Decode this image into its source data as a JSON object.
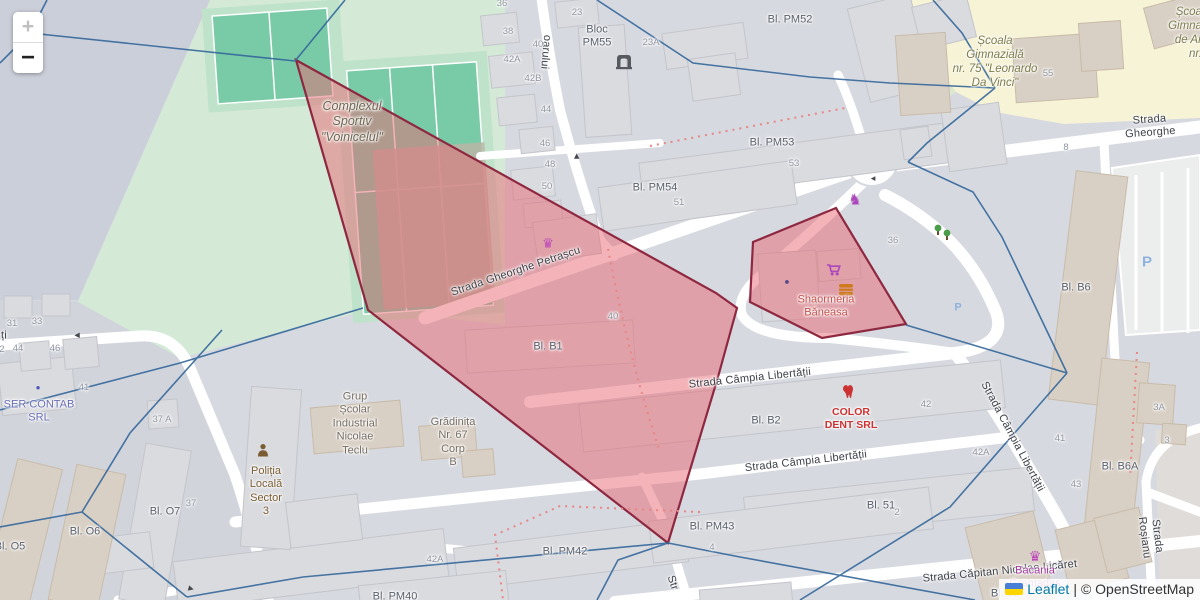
{
  "controls": {
    "zoom_in": "+",
    "zoom_out": "−"
  },
  "attribution": {
    "leaflet": "Leaflet",
    "separator": "|",
    "osm": "© OpenStreetMap"
  },
  "colors": {
    "selection_fill": "#e86771",
    "selection_stroke": "#8e2840",
    "voronoi_line": "#34679b",
    "park": "#d4ead7",
    "pitch": "#79cba8",
    "school_area": "#f6f3d6",
    "road": "#ffffff",
    "building_gray": "#dadbdf",
    "building_tan": "#d9d0c5",
    "leaflet_link": "#0078a8",
    "dotted_path": "#e98585"
  },
  "streets": {
    "petrascu": "Strada Gheorghe Petrașcu",
    "campia1": "Strada Câmpia Libertății",
    "campia2": "Strada Câmpia Libertății",
    "campia_v": "Strada Câmpia Libertății",
    "licaret": "Strada Căpitan Nicolae Licăret",
    "gheorghe": "Strada Gheorghe",
    "rosianu": "Strada Roșianu",
    "oarului": "oarului",
    "str_frag": "Str",
    "tii_frag": "ți"
  },
  "blocks": {
    "pm52": "Bl. PM52",
    "pm55": "Bloc\nPM55",
    "pm53": "Bl. PM53",
    "pm54": "Bl. PM54",
    "b1": "Bl. B1",
    "b2": "Bl. B2",
    "b51": "Bl. 51",
    "pm42": "Bl. PM42",
    "pm43": "Bl. PM43",
    "pm40": "Bl. PM40",
    "o7": "Bl. O7",
    "o6": "Bl. O6",
    "o5": "Bl. O5",
    "b6": "Bl. B6",
    "b6a": "Bl. B6A",
    "b52": "Bl. 52"
  },
  "pois": {
    "complexul": "Complexul\nSportiv\n\"Voinicelul\"",
    "scoala75": "Școala\nGimnazială\nnr. 75 \"Leonardo\nDa Vinci\"",
    "scoala_arte": "Școa\nGimna\nde Ar\nnr.",
    "grup": "Grup\nȘcolar\nIndustrial\nNicolae\nTeclu",
    "gradinita": "Grădinița\nNr. 67\nCorp\nB",
    "politia": "Poliția\nLocală\nSector\n3",
    "shaormeria": "Shaormeria\nBăneasa",
    "colordent": "COLOR\nDENT SRL",
    "sercontab": "SER CONTAB\nSRL",
    "bacania": "Bacania\nGramadas"
  },
  "house_numbers": {
    "h36": "36",
    "h38": "38",
    "h40": "40",
    "h42a": "42A",
    "h42b": "42B",
    "h44": "44",
    "h46": "46",
    "h48": "48",
    "h50": "50",
    "h23": "23",
    "h23a": "23A",
    "h55": "55",
    "h53": "53",
    "h51": "51",
    "h40r": "40",
    "h36s": "36",
    "h42": "42",
    "h42ar": "42A",
    "h2r": "2",
    "h8": "8",
    "h41r": "41",
    "h43r": "43",
    "h3a": "3A",
    "h3r": "3",
    "h37a": "37 A",
    "h37": "37",
    "h4r": "4",
    "h42ab": "42A",
    "h31": "31",
    "h33": "33",
    "h44l": "44",
    "h46l": "46",
    "h41l": "41",
    "h2l": "2"
  },
  "icons": {
    "crown": "♛",
    "horse": "♞",
    "tree": "♣",
    "parking": "P",
    "arrow": "▶",
    "dot": "●"
  }
}
